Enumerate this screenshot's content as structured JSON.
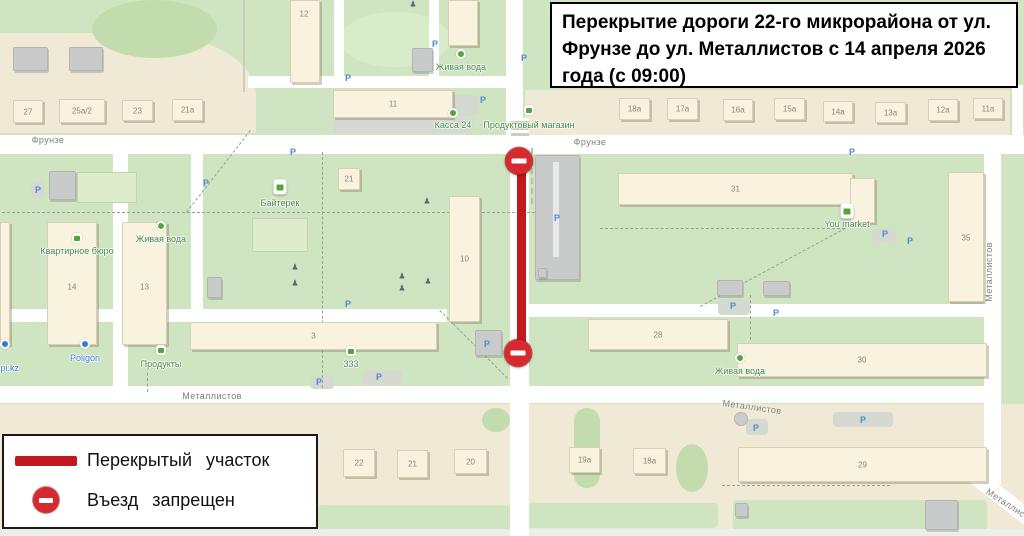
{
  "title_box": {
    "text": "Перекрытие дороги 22-го микрорайона от ул. Фрунзе до ул. Металлистов с 14 апреля 2026 года (с 09:00)"
  },
  "legend": {
    "closed_section_label": "Перекрытый участок",
    "no_entry_label": "Въезд запрещен"
  },
  "colors": {
    "closed_line": "#c2191f",
    "no_entry_fill": "#d62a2f",
    "map_green": "#cfe5c1",
    "landuse_beige": "#f0e9d5",
    "road": "#ffffff",
    "poi_green": "#3f8742",
    "poi_blue": "#2e7fd0",
    "street_label": "#7b8377",
    "building_label": "#8d8672"
  },
  "map": {
    "streets": [
      {
        "name": "Фрунзе",
        "x": 48,
        "y": 140,
        "rot": 0
      },
      {
        "name": "Фрунзе",
        "x": 590,
        "y": 142,
        "rot": 0
      },
      {
        "name": "Металлистов",
        "x": 212,
        "y": 396,
        "rot": 0
      },
      {
        "name": "Металлистов",
        "x": 752,
        "y": 407,
        "rot": 8
      },
      {
        "name": "Металлистов",
        "x": 989,
        "y": 272,
        "rot": -90
      },
      {
        "name": "Металлистов",
        "x": 1012,
        "y": 507,
        "rot": 33
      }
    ],
    "buildings": [
      {
        "label": "27",
        "x": 13,
        "y": 100,
        "w": 30,
        "h": 23
      },
      {
        "label": "25а/2",
        "x": 59,
        "y": 99,
        "w": 46,
        "h": 24
      },
      {
        "label": "23",
        "x": 122,
        "y": 100,
        "w": 31,
        "h": 21
      },
      {
        "label": "21а",
        "x": 172,
        "y": 99,
        "w": 31,
        "h": 22
      },
      {
        "label": "12",
        "x": 290,
        "y": 0,
        "w": 30,
        "h": 83,
        "lx": 304,
        "ly": 14
      },
      {
        "label": "11",
        "x": 333,
        "y": 90,
        "w": 120,
        "h": 28
      },
      {
        "label": "",
        "x": 448,
        "y": 0,
        "w": 30,
        "h": 46
      },
      {
        "label": "18а",
        "x": 619,
        "y": 98,
        "w": 31,
        "h": 22
      },
      {
        "label": "17а",
        "x": 667,
        "y": 98,
        "w": 31,
        "h": 22
      },
      {
        "label": "16а",
        "x": 723,
        "y": 99,
        "w": 30,
        "h": 22
      },
      {
        "label": "15а",
        "x": 774,
        "y": 98,
        "w": 31,
        "h": 22
      },
      {
        "label": "14а",
        "x": 823,
        "y": 101,
        "w": 30,
        "h": 21
      },
      {
        "label": "13а",
        "x": 875,
        "y": 102,
        "w": 31,
        "h": 21
      },
      {
        "label": "12а",
        "x": 928,
        "y": 99,
        "w": 30,
        "h": 22
      },
      {
        "label": "11а",
        "x": 973,
        "y": 98,
        "w": 30,
        "h": 21
      },
      {
        "label": "14",
        "x": 47,
        "y": 222,
        "w": 50,
        "h": 123,
        "ly": 287
      },
      {
        "label": "13",
        "x": 122,
        "y": 222,
        "w": 45,
        "h": 123,
        "ly": 287
      },
      {
        "label": "",
        "x": 0,
        "y": 222,
        "w": 10,
        "h": 123
      },
      {
        "label": "21",
        "x": 338,
        "y": 168,
        "w": 22,
        "h": 22
      },
      {
        "label": "10",
        "x": 449,
        "y": 196,
        "w": 31,
        "h": 126,
        "ly": 259
      },
      {
        "label": "3",
        "x": 190,
        "y": 322,
        "w": 247,
        "h": 28
      },
      {
        "label": "28",
        "x": 588,
        "y": 319,
        "w": 140,
        "h": 31
      },
      {
        "label": "31",
        "x": 618,
        "y": 173,
        "w": 235,
        "h": 32
      },
      {
        "label": "",
        "x": 850,
        "y": 178,
        "w": 25,
        "h": 45
      },
      {
        "label": "35",
        "x": 948,
        "y": 172,
        "w": 36,
        "h": 130,
        "ly": 238
      },
      {
        "label": "30",
        "x": 737,
        "y": 343,
        "w": 250,
        "h": 34
      },
      {
        "label": "29",
        "x": 738,
        "y": 447,
        "w": 249,
        "h": 35
      },
      {
        "label": "22",
        "x": 343,
        "y": 449,
        "w": 32,
        "h": 28
      },
      {
        "label": "21",
        "x": 397,
        "y": 450,
        "w": 31,
        "h": 28
      },
      {
        "label": "20",
        "x": 454,
        "y": 449,
        "w": 33,
        "h": 25
      },
      {
        "label": "19а",
        "x": 569,
        "y": 447,
        "w": 31,
        "h": 26
      },
      {
        "label": "18а",
        "x": 633,
        "y": 448,
        "w": 33,
        "h": 26
      }
    ],
    "service_buildings": [
      {
        "x": 13,
        "y": 47,
        "w": 35,
        "h": 24
      },
      {
        "x": 69,
        "y": 47,
        "w": 34,
        "h": 24
      },
      {
        "x": 412,
        "y": 48,
        "w": 21,
        "h": 24
      },
      {
        "x": 49,
        "y": 171,
        "w": 27,
        "h": 29
      },
      {
        "x": 207,
        "y": 277,
        "w": 15,
        "h": 21
      },
      {
        "x": 535,
        "y": 155,
        "w": 45,
        "h": 125
      },
      {
        "x": 538,
        "y": 268,
        "w": 9,
        "h": 10
      },
      {
        "x": 717,
        "y": 280,
        "w": 26,
        "h": 16
      },
      {
        "x": 763,
        "y": 281,
        "w": 27,
        "h": 15
      },
      {
        "x": 475,
        "y": 330,
        "w": 27,
        "h": 26
      },
      {
        "x": 735,
        "y": 503,
        "w": 13,
        "h": 14
      },
      {
        "x": 925,
        "y": 500,
        "w": 33,
        "h": 30
      }
    ],
    "fields": [
      {
        "x": 77,
        "y": 172,
        "w": 60,
        "h": 31
      },
      {
        "x": 252,
        "y": 218,
        "w": 56,
        "h": 34
      }
    ],
    "pois": [
      {
        "label": "Живая вода",
        "type": "cross",
        "x": 461,
        "iy": 54,
        "ly": 67,
        "c": "green"
      },
      {
        "label": "Касса 24",
        "type": "dot",
        "x": 453,
        "iy": 113,
        "ly": 125,
        "c": "green"
      },
      {
        "label": "Продуктовый магазин",
        "type": "basket",
        "x": 529,
        "iy": 110,
        "ly": 125,
        "c": "green"
      },
      {
        "label": "Байтерек",
        "type": "marker",
        "x": 280,
        "iy": 187,
        "ly": 203,
        "c": "green"
      },
      {
        "label": "Квартирное бюро",
        "type": "basket",
        "x": 77,
        "iy": 238,
        "ly": 251,
        "c": "green"
      },
      {
        "label": "Живая вода",
        "type": "cross",
        "x": 161,
        "iy": 226,
        "ly": 239,
        "c": "green"
      },
      {
        "label": "You market",
        "type": "marker",
        "x": 847,
        "iy": 211,
        "ly": 224,
        "c": "green"
      },
      {
        "label": "Живая вода",
        "type": "cross",
        "x": 740,
        "iy": 358,
        "ly": 371,
        "c": "green"
      },
      {
        "label": "Продукты",
        "type": "basket",
        "x": 161,
        "iy": 350,
        "ly": 364,
        "c": "green"
      },
      {
        "label": "333",
        "type": "basket",
        "x": 351,
        "iy": 351,
        "ly": 364,
        "c": "green"
      },
      {
        "label": "Poligon",
        "type": "bluedot",
        "x": 85,
        "iy": 344,
        "ly": 358,
        "c": "blue"
      },
      {
        "label": "aspi.kz",
        "type": "bluedot",
        "x": 5,
        "iy": 344,
        "ly": 368,
        "c": "blue"
      }
    ],
    "parking": [
      {
        "x": 38,
        "y": 190
      },
      {
        "x": 206,
        "y": 183
      },
      {
        "x": 293,
        "y": 152
      },
      {
        "x": 348,
        "y": 78
      },
      {
        "x": 435,
        "y": 44
      },
      {
        "x": 483,
        "y": 100
      },
      {
        "x": 524,
        "y": 58
      },
      {
        "x": 557,
        "y": 218
      },
      {
        "x": 348,
        "y": 304
      },
      {
        "x": 319,
        "y": 382
      },
      {
        "x": 379,
        "y": 377
      },
      {
        "x": 733,
        "y": 306
      },
      {
        "x": 776,
        "y": 313
      },
      {
        "x": 885,
        "y": 234
      },
      {
        "x": 910,
        "y": 241
      },
      {
        "x": 852,
        "y": 152
      },
      {
        "x": 863,
        "y": 420
      },
      {
        "x": 756,
        "y": 428
      },
      {
        "x": 487,
        "y": 344
      }
    ],
    "lamps": [
      {
        "x": 295,
        "y": 267
      },
      {
        "x": 295,
        "y": 283
      },
      {
        "x": 402,
        "y": 276
      },
      {
        "x": 402,
        "y": 288
      },
      {
        "x": 427,
        "y": 201
      },
      {
        "x": 428,
        "y": 281
      },
      {
        "x": 413,
        "y": 4
      }
    ],
    "no_entry_signs": [
      {
        "x": 519,
        "y": 161
      },
      {
        "x": 518,
        "y": 353
      }
    ],
    "closed_line": {
      "x": 517,
      "y1": 161,
      "y2": 353,
      "w": 9
    }
  }
}
